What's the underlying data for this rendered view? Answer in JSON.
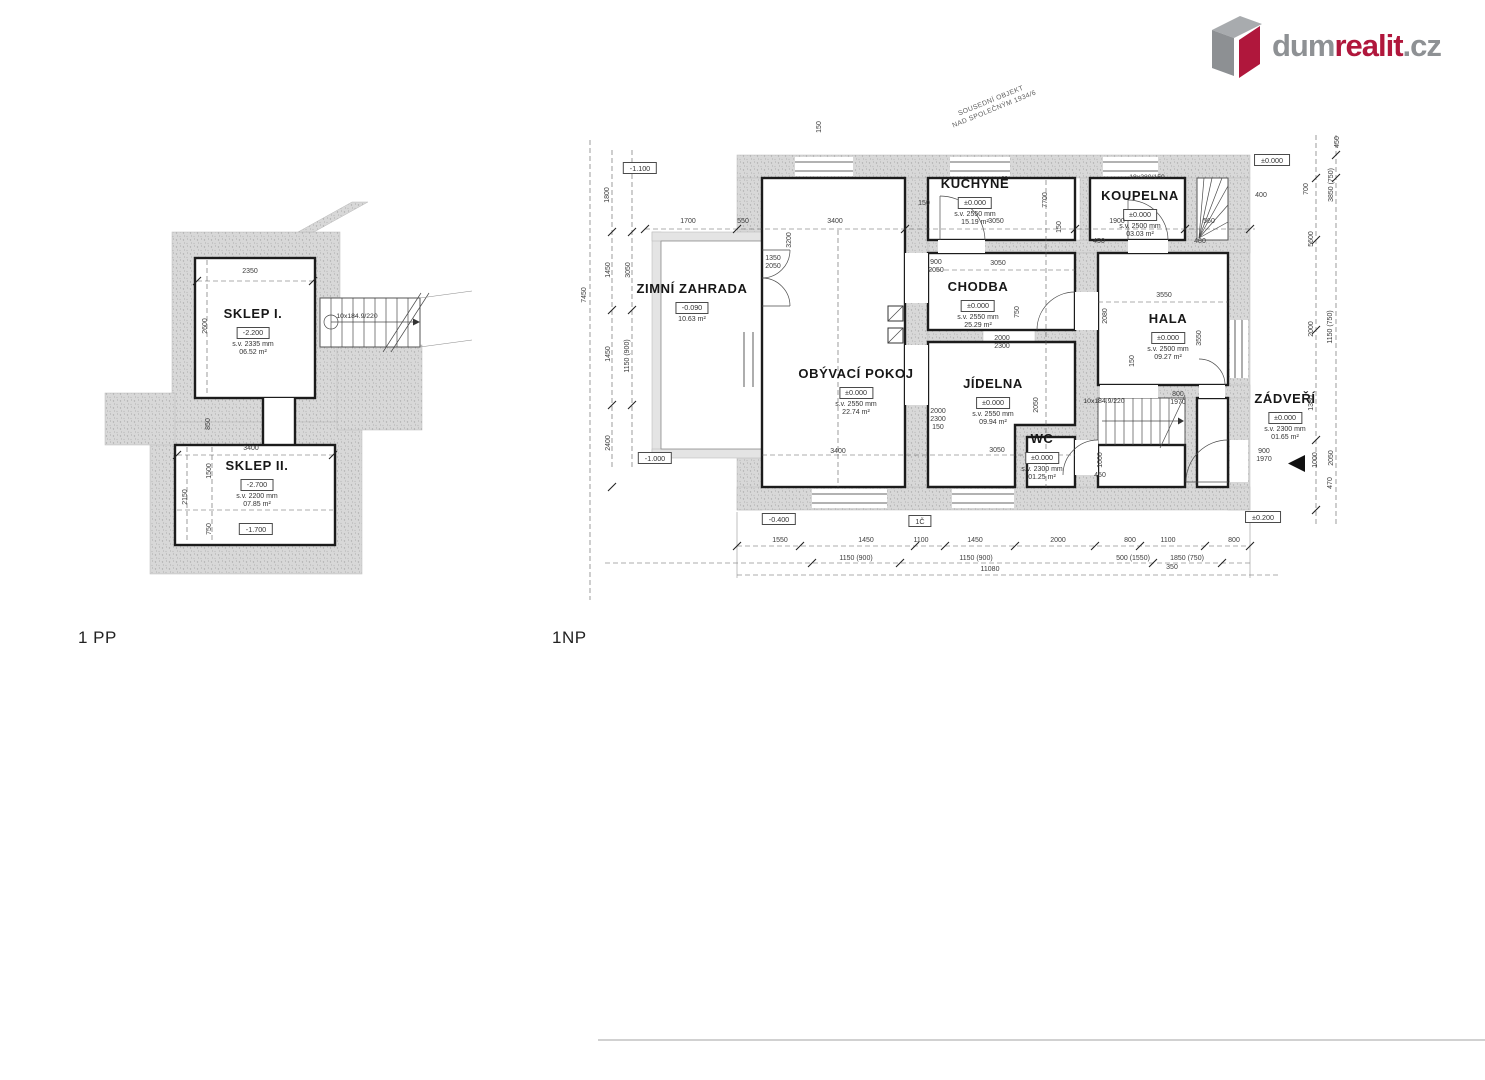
{
  "logo": {
    "prefix": "dum",
    "accent": "realit",
    "suffix": ".cz",
    "gray": "#8e9194",
    "red": "#b0173c"
  },
  "plans": {
    "basement": {
      "floor_label": "1 PP",
      "rooms": [
        {
          "id": "sklep-1",
          "name": "SKLEP I.",
          "level": "-2.200",
          "sv": "s.v. 2335 mm",
          "area": "06.52 m²",
          "x": 253,
          "y": 306
        },
        {
          "id": "sklep-2",
          "name": "SKLEP II.",
          "level": "-2.700",
          "sv": "s.v. 2200 mm",
          "area": "07.85 m²",
          "x": 257,
          "y": 458
        }
      ],
      "boxes": [
        {
          "t": "-1.700",
          "x": 256,
          "y": 529
        }
      ],
      "stairs": [
        {
          "t": "10x184.9/220",
          "x": 357,
          "y": 317
        }
      ],
      "dims": [
        {
          "t": "2350",
          "x": 250,
          "y": 272
        },
        {
          "t": "2600",
          "x": 206,
          "y": 326,
          "r": 1
        },
        {
          "t": "3400",
          "x": 251,
          "y": 449
        },
        {
          "t": "2150",
          "x": 186,
          "y": 497,
          "r": 1
        },
        {
          "t": "1500",
          "x": 210,
          "y": 471,
          "r": 1
        },
        {
          "t": "750",
          "x": 210,
          "y": 529,
          "r": 1
        },
        {
          "t": "850",
          "x": 209,
          "y": 424,
          "r": 1
        }
      ]
    },
    "ground": {
      "floor_label": "1NP",
      "note": {
        "lines": [
          "SOUSEDNÍ OBJEKT",
          "NAD SPOLEČNÝM 1934/6"
        ],
        "x": 993,
        "y": 106
      },
      "rooms": [
        {
          "id": "kuchyne",
          "name": "KUCHYNĚ",
          "level": "±0.000",
          "sv": "s.v. 2550 mm",
          "area": "15.19 m²",
          "x": 975,
          "y": 176
        },
        {
          "id": "koupelna",
          "name": "KOUPELNA",
          "level": "±0.000",
          "sv": "s.v. 2500 mm",
          "area": "03.03 m²",
          "x": 1140,
          "y": 188
        },
        {
          "id": "zimni-zahrada",
          "name": "ZIMNÍ ZAHRADA",
          "level": "-0.090",
          "area": "10.63 m²",
          "x": 692,
          "y": 281
        },
        {
          "id": "chodba",
          "name": "CHODBA",
          "level": "±0.000",
          "sv": "s.v. 2550 mm",
          "area": "25.29 m²",
          "x": 978,
          "y": 279
        },
        {
          "id": "obyvaci-pokoj",
          "name": "OBÝVACÍ POKOJ",
          "level": "±0.000",
          "sv": "s.v. 2550 mm",
          "area": "22.74 m²",
          "x": 856,
          "y": 366
        },
        {
          "id": "jidelna",
          "name": "JÍDELNA",
          "level": "±0.000",
          "sv": "s.v. 2550 mm",
          "area": "09.94 m²",
          "x": 993,
          "y": 376
        },
        {
          "id": "wc",
          "name": "WC",
          "level": "±0.000",
          "sv": "s.v. 2300 mm",
          "area": "01.25 m²",
          "x": 1042,
          "y": 431
        },
        {
          "id": "hala",
          "name": "HALA",
          "level": "±0.000",
          "sv": "s.v. 2500 mm",
          "area": "09.27 m²",
          "x": 1168,
          "y": 311
        },
        {
          "id": "zadveri",
          "name": "ZÁDVEŘÍ",
          "level": "±0.000",
          "sv": "s.v. 2300 mm",
          "area": "01.65 m²",
          "x": 1285,
          "y": 391
        }
      ],
      "boxes": [
        {
          "t": "-1.100",
          "x": 640,
          "y": 168
        },
        {
          "t": "-1.000",
          "x": 655,
          "y": 458
        },
        {
          "t": "-0.400",
          "x": 779,
          "y": 519
        },
        {
          "t": "1Č",
          "x": 920,
          "y": 521
        },
        {
          "t": "±0.200",
          "x": 1263,
          "y": 517
        },
        {
          "t": "±0.000",
          "x": 1272,
          "y": 160
        }
      ],
      "stairs": [
        {
          "t": "10x184.9/220",
          "x": 1104,
          "y": 402
        },
        {
          "t": "18x280/150",
          "x": 1147,
          "y": 178
        }
      ],
      "dims": [
        {
          "t": "1700",
          "x": 688,
          "y": 222
        },
        {
          "t": "550",
          "x": 743,
          "y": 222
        },
        {
          "t": "3400",
          "x": 835,
          "y": 222
        },
        {
          "t": "150",
          "x": 924,
          "y": 204
        },
        {
          "t": "3050",
          "x": 996,
          "y": 222
        },
        {
          "t": "1900",
          "x": 1117,
          "y": 222
        },
        {
          "t": "560",
          "x": 1209,
          "y": 222
        },
        {
          "t": "450",
          "x": 1099,
          "y": 242
        },
        {
          "t": "480",
          "x": 1200,
          "y": 242
        },
        {
          "t": "3200",
          "x": 790,
          "y": 240,
          "r": 1
        },
        {
          "t": "7700",
          "x": 1046,
          "y": 200,
          "r": 1
        },
        {
          "t": "150",
          "x": 1060,
          "y": 227,
          "r": 1
        },
        {
          "t": "150",
          "x": 820,
          "y": 127,
          "r": 1
        },
        {
          "t": "400",
          "x": 1261,
          "y": 196
        },
        {
          "t": "1350\n2050",
          "x": 773,
          "y": 263
        },
        {
          "t": "900\n2050",
          "x": 936,
          "y": 267
        },
        {
          "t": "3050",
          "x": 998,
          "y": 264
        },
        {
          "t": "750",
          "x": 1018,
          "y": 312,
          "r": 1
        },
        {
          "t": "2000\n2300",
          "x": 1002,
          "y": 343
        },
        {
          "t": "2000\n2300\n150",
          "x": 938,
          "y": 420
        },
        {
          "t": "3400",
          "x": 838,
          "y": 452
        },
        {
          "t": "3050",
          "x": 997,
          "y": 451
        },
        {
          "t": "2050",
          "x": 1037,
          "y": 405,
          "r": 1
        },
        {
          "t": "3550",
          "x": 1164,
          "y": 296
        },
        {
          "t": "2080",
          "x": 1106,
          "y": 316,
          "r": 1
        },
        {
          "t": "3550",
          "x": 1200,
          "y": 338,
          "r": 1
        },
        {
          "t": "150",
          "x": 1133,
          "y": 361,
          "r": 1
        },
        {
          "t": "800\n1970",
          "x": 1178,
          "y": 399
        },
        {
          "t": "900\n1970",
          "x": 1264,
          "y": 456
        },
        {
          "t": "1000",
          "x": 1101,
          "y": 460,
          "r": 1
        },
        {
          "t": "450",
          "x": 1100,
          "y": 476
        },
        {
          "t": "1800",
          "x": 608,
          "y": 195,
          "r": 1
        },
        {
          "t": "1450",
          "x": 609,
          "y": 270,
          "r": 1
        },
        {
          "t": "3050",
          "x": 629,
          "y": 270,
          "r": 1
        },
        {
          "t": "1150 (900)",
          "x": 628,
          "y": 356,
          "r": 1
        },
        {
          "t": "1450",
          "x": 609,
          "y": 354,
          "r": 1
        },
        {
          "t": "2400",
          "x": 609,
          "y": 443,
          "r": 1
        },
        {
          "t": "7450",
          "x": 585,
          "y": 295,
          "r": 1
        },
        {
          "t": "450",
          "x": 1338,
          "y": 142,
          "r": 1
        },
        {
          "t": "700",
          "x": 1307,
          "y": 189,
          "r": 1
        },
        {
          "t": "3850 (750)",
          "x": 1332,
          "y": 185,
          "r": 1
        },
        {
          "t": "5600",
          "x": 1312,
          "y": 239,
          "r": 1
        },
        {
          "t": "2000",
          "x": 1312,
          "y": 329,
          "r": 1
        },
        {
          "t": "1150 (750)",
          "x": 1331,
          "y": 327,
          "r": 1
        },
        {
          "t": "1380",
          "x": 1312,
          "y": 403,
          "r": 1
        },
        {
          "t": "1000",
          "x": 1316,
          "y": 460,
          "r": 1
        },
        {
          "t": "2050",
          "x": 1332,
          "y": 458,
          "r": 1
        },
        {
          "t": "470",
          "x": 1331,
          "y": 483,
          "r": 1
        },
        {
          "t": "1550",
          "x": 780,
          "y": 541
        },
        {
          "t": "1450",
          "x": 866,
          "y": 541
        },
        {
          "t": "1100",
          "x": 921,
          "y": 541
        },
        {
          "t": "1450",
          "x": 975,
          "y": 541
        },
        {
          "t": "2000",
          "x": 1058,
          "y": 541
        },
        {
          "t": "800",
          "x": 1130,
          "y": 541
        },
        {
          "t": "1100",
          "x": 1168,
          "y": 541
        },
        {
          "t": "800",
          "x": 1234,
          "y": 541
        },
        {
          "t": "1150 (900)",
          "x": 856,
          "y": 559
        },
        {
          "t": "1150 (900)",
          "x": 976,
          "y": 559
        },
        {
          "t": "500 (1550)",
          "x": 1133,
          "y": 559
        },
        {
          "t": "1850 (750)",
          "x": 1187,
          "y": 559
        },
        {
          "t": "350",
          "x": 1172,
          "y": 568
        },
        {
          "t": "11080",
          "x": 990,
          "y": 570
        }
      ]
    }
  }
}
